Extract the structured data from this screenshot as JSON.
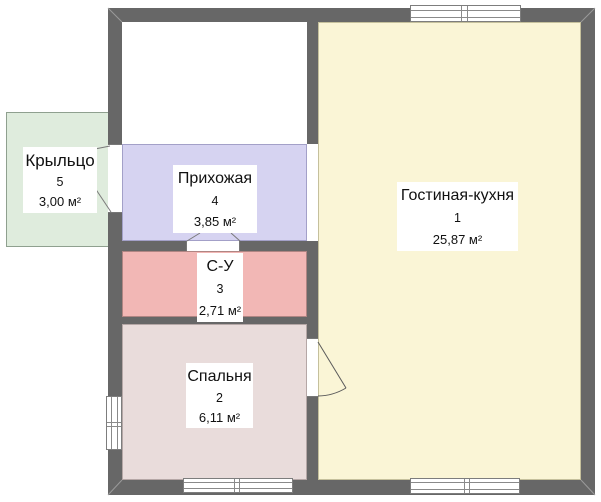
{
  "plan": {
    "colors": {
      "background": "#ffffff",
      "wall": "#676767",
      "porch": "#dfecdd",
      "hallway": "#d6d3f1",
      "bathroom": "#f2b7b5",
      "bedroom": "#e9dcdb",
      "living": "#faf5d6",
      "text": "#111111"
    },
    "rooms": {
      "living": {
        "name": "Гостиная-кухня",
        "number": "1",
        "area": "25,87 м²"
      },
      "bedroom": {
        "name": "Спальня",
        "number": "2",
        "area": "6,11 м²"
      },
      "bathroom": {
        "name": "С-У",
        "number": "3",
        "area": "2,71 м²"
      },
      "hallway": {
        "name": "Прихожая",
        "number": "4",
        "area": "3,85 м²"
      },
      "porch": {
        "name": "Крыльцо",
        "number": "5",
        "area": "3,00 м²"
      }
    }
  }
}
